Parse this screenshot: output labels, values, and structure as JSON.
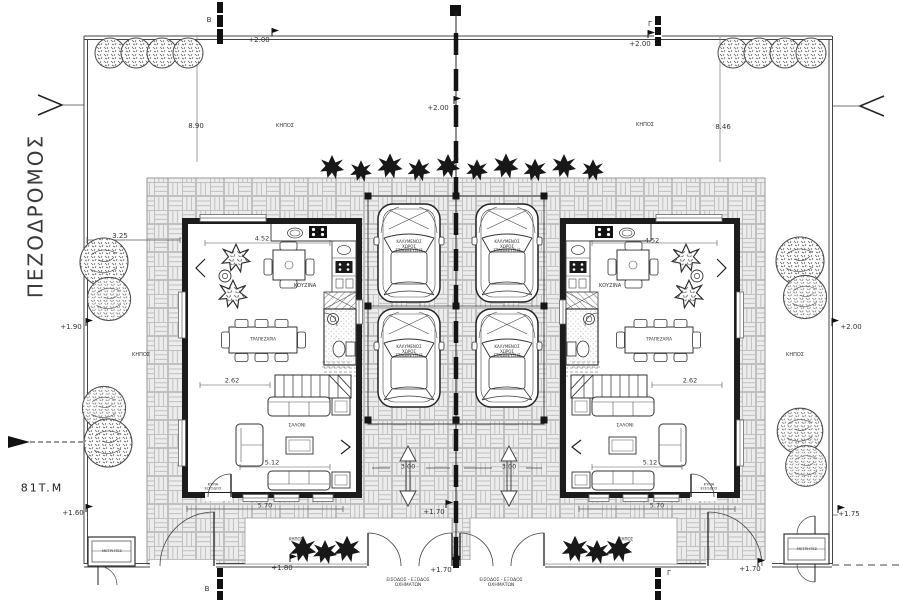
{
  "palette": {
    "ink": "#2a2a2a",
    "paving_bg": "#ececec",
    "paving_line": "#c0c0c0"
  },
  "site": {
    "street_label": "ΠΕΖΟΔΡΟΜΟΣ",
    "plot_area_label": "81T.M",
    "garden_label": "ΚΗΠΟΣ",
    "meter_box_label": "ΜΕΤΡΗΤΕΣ",
    "section_marker_b": "Β",
    "section_marker_g": "Γ"
  },
  "levels": {
    "top_left": "+2.00",
    "top_center": "+2.00",
    "top_right": "+2.00",
    "right_boundary": "+2.00",
    "left_boundary_mid": "+1.90",
    "left_boundary_low": "+1.60",
    "bottom_left_bed": "+1.80",
    "center_walkway": "+1.70",
    "bottom_center": "+1.70",
    "bottom_right_inner": "+1.70",
    "bottom_right_gate": "+1.75"
  },
  "dimensions": {
    "left_garden_width": "8.90",
    "right_garden_width": "8.46",
    "side_setback": "3.25",
    "kitchen_front": "4.52",
    "stair_span": "2.62",
    "living_span": "5.12",
    "house_front": "5.70",
    "carport_bay_left": "3.00",
    "carport_bay_right": "3.00"
  },
  "rooms": {
    "kitchen": "ΚΟΥΖΙΝΑ",
    "dining": "ΤΡΑΠΕΖΑΡΙΑ",
    "living": "ΣΑΛΟΝΙ",
    "entrance_line1": "ΚΥΡΙΑ",
    "entrance_line2": "ΕΙΣΟΔΟΣ",
    "carport_line1": "ΚΑΛΥΜΕΝΟΣ",
    "carport_line2": "ΧΩΡΟΣ",
    "carport_line3": "ΣΤΑΘΜΕΥΣΗΣ"
  },
  "gates": {
    "vehicle_line1": "ΕΙΣΟΔΟΣ - ΕΞΟΔΟΣ",
    "vehicle_line2": "ΟΧΗΜΑΤΩΝ"
  }
}
